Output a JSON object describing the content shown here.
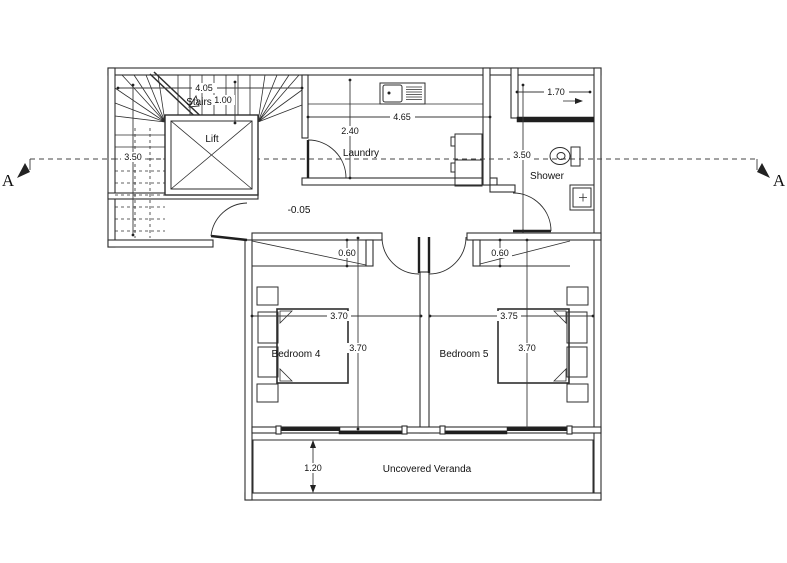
{
  "title": "First floor plan",
  "section": {
    "marker_left": "A",
    "marker_right": "A"
  },
  "labels": {
    "stairs": "Stairs",
    "lift": "Lift",
    "laundry": "Laundry",
    "shower": "Shower",
    "bedroom4": "Bedroom 4",
    "bedroom5": "Bedroom 5",
    "veranda": "Uncovered Veranda",
    "floor_level": "-0.05"
  },
  "dimensions": {
    "stairs_width": "4.05",
    "stairs_flight": "1.00",
    "stairs_depth": "3.50",
    "laundry_width": "4.65",
    "laundry_depth": "2.40",
    "shower_width": "1.70",
    "shower_depth": "3.50",
    "closet_bedroom4_depth": "0.60",
    "closet_bedroom5_depth": "0.60",
    "bedroom4_width": "3.70",
    "bedroom4_depth": "3.70",
    "bedroom5_width": "3.75",
    "bedroom5_depth": "3.70",
    "veranda_depth": "1.20"
  },
  "colors": {
    "line": "#2e2e2e",
    "dark_fill": "#1f1f1f",
    "background": "#ffffff"
  }
}
